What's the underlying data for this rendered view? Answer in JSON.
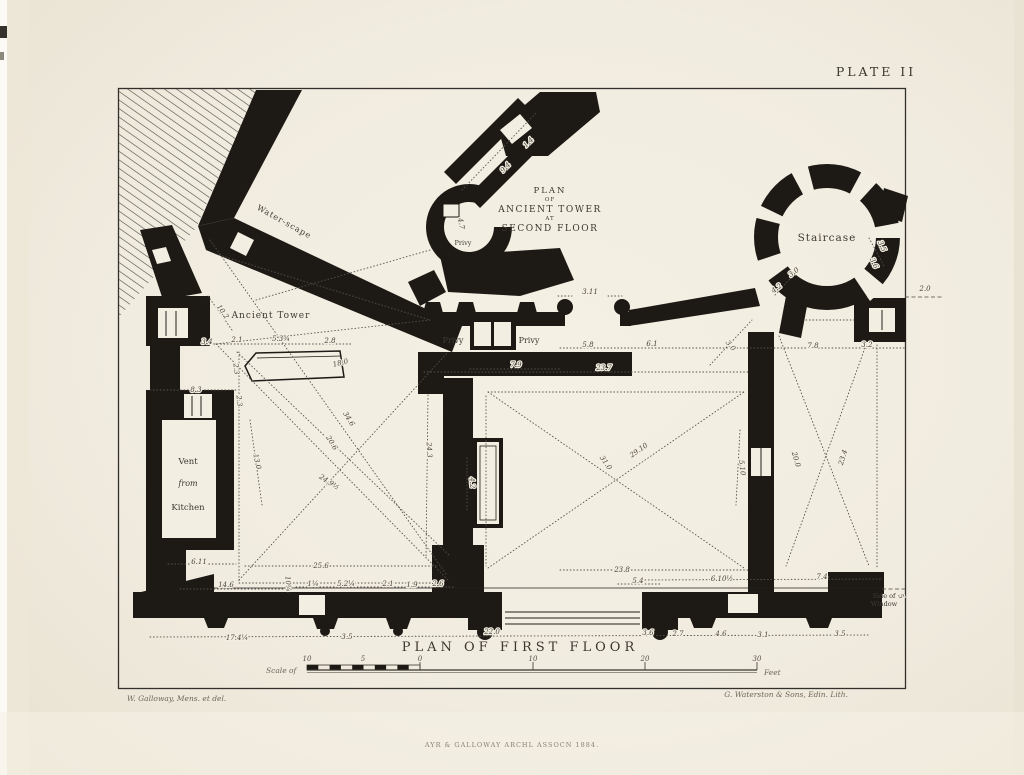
{
  "page": {
    "kind": "engraved architectural plate",
    "paper_color": "#f2eee2",
    "ink_color": "#1d1a15"
  },
  "plate": {
    "label": "PLATE II"
  },
  "inset_title": {
    "line1": "PLAN",
    "line2": "OF",
    "line3": "ANCIENT TOWER",
    "line4": "AT",
    "line5": "SECOND FLOOR"
  },
  "main_title": "PLAN OF FIRST FLOOR",
  "labels": {
    "staircase": "Staircase",
    "ancient_tower": "Ancient Tower",
    "water_scape": "Water-scape",
    "vent1": "Vent",
    "vent2": "from",
    "vent3": "Kitchen",
    "privy_left": "Privy",
    "privy_right": "Privy",
    "privy_inset": "Privy",
    "side_of_window1": "Side of",
    "side_of_window2": "Window"
  },
  "scale_bar": {
    "prefix": "Scale of",
    "suffix": "Feet",
    "ticks": [
      "10",
      "5",
      "0",
      "10",
      "20",
      "30"
    ]
  },
  "credits": {
    "surveyor": "W. Galloway, Mens. et del.",
    "lithographer": "G. Waterston & Sons, Edin. Lith.",
    "imprint": "AYR & GALLOWAY ARCHL ASSOCN 1884."
  },
  "dims": [
    "3.11",
    "5.8",
    "6.1",
    "3.0",
    "7.8",
    "3.2",
    "23.7",
    "7.9",
    "29.10",
    "31.0",
    "5.10",
    "34.6",
    "20.6",
    "24.9½",
    "24.3",
    "13.0",
    "8.3",
    "3.4",
    "2.1",
    "5.3¾",
    "2.8",
    "18.0",
    "2.3",
    "2.3",
    "10.2",
    "6.11",
    "25.6",
    "14.6",
    "17.4¼",
    "1¼",
    "5.2¼",
    "2.1",
    "1.9",
    "2.6",
    "10¼",
    "3.5",
    "22.0",
    "3.6",
    "2.7",
    "4.6",
    "3.1",
    "3.5",
    "23.8",
    "5.4",
    "6.10½",
    "7.4",
    "3.0",
    "4.2",
    "3.5",
    "3.6",
    "2.0",
    "20.0",
    "23.4",
    "9.4",
    "1.4",
    "4.7",
    "4.2",
    "5"
  ]
}
